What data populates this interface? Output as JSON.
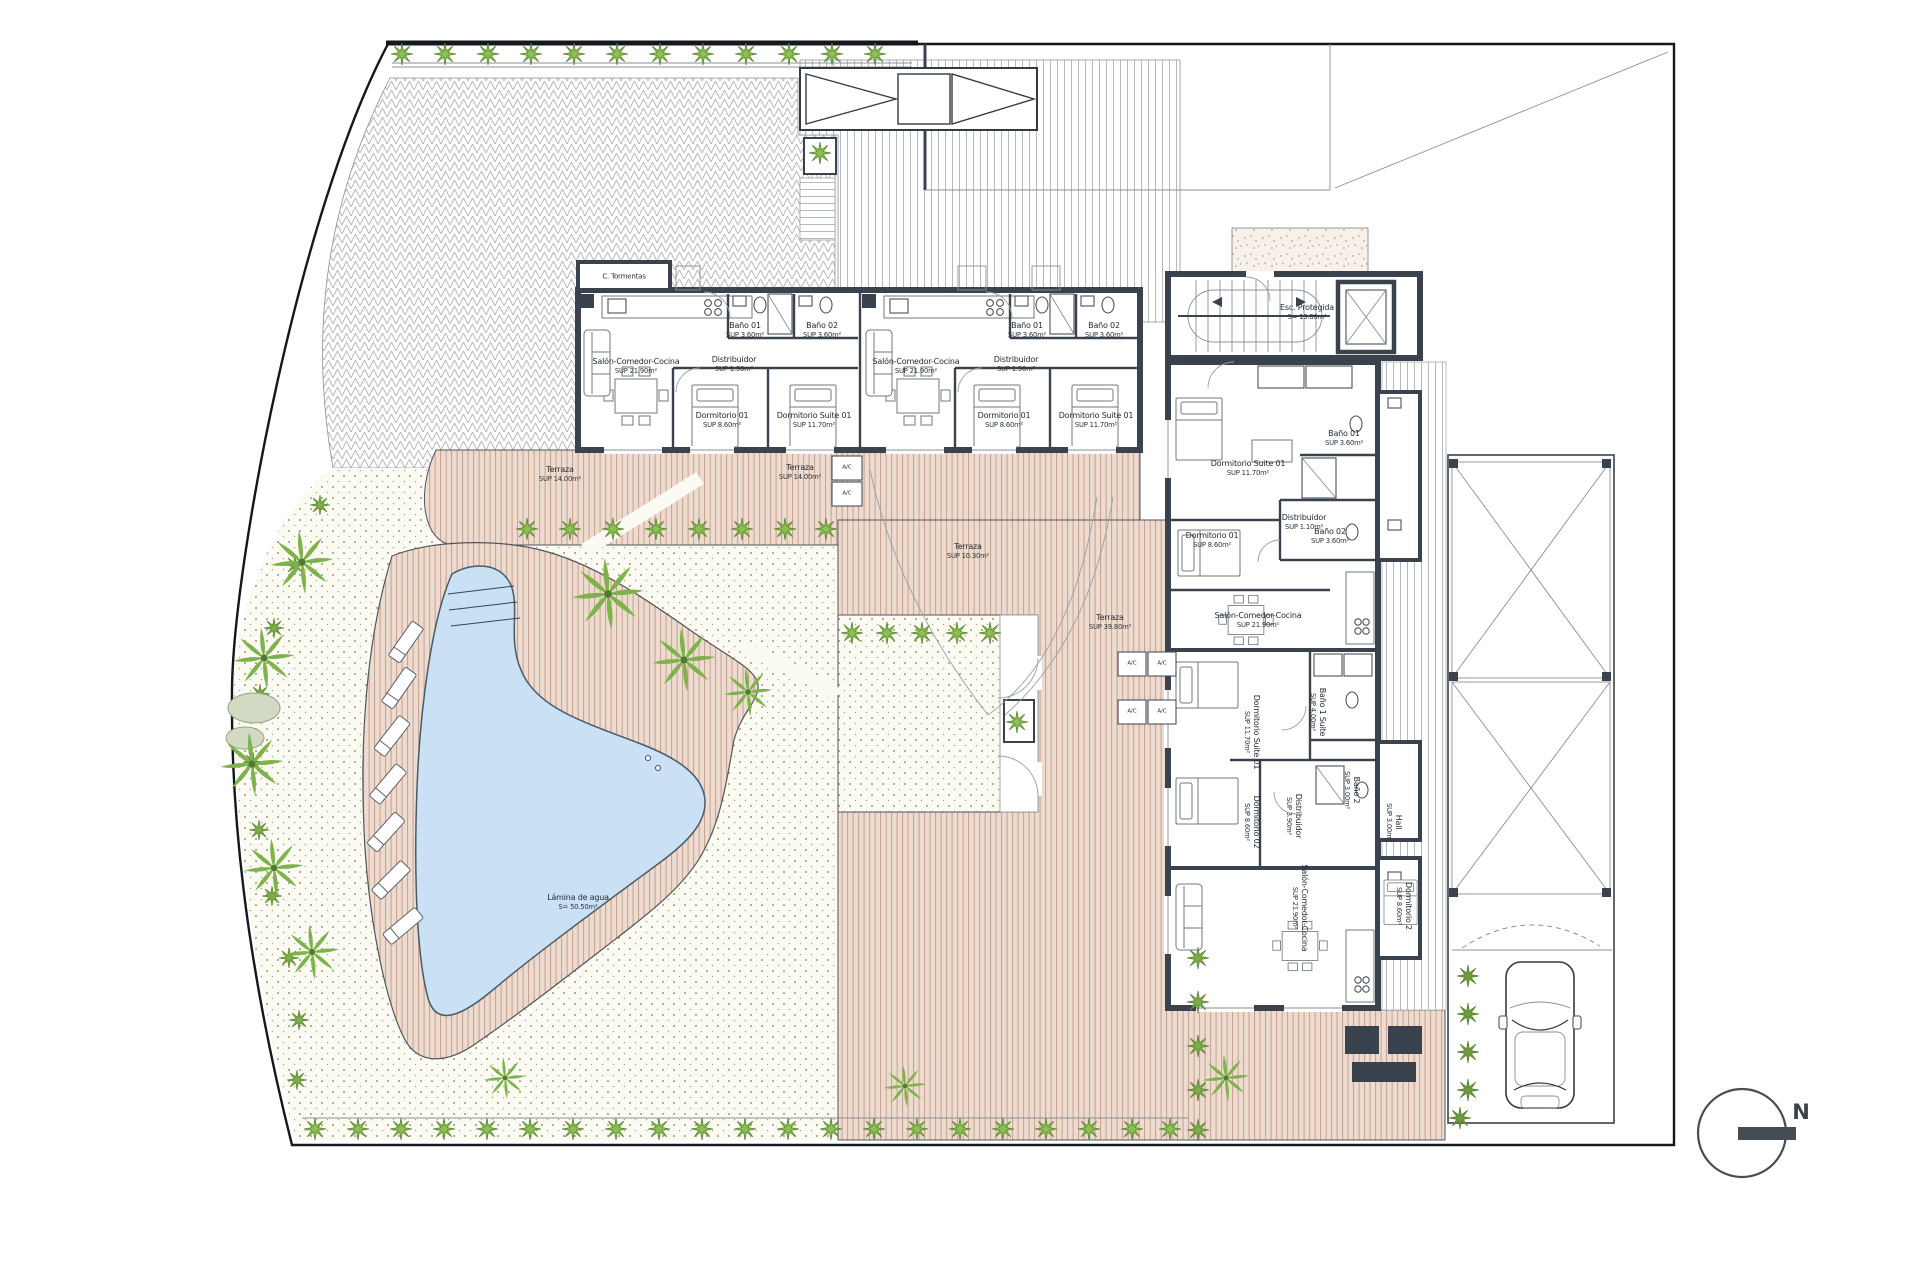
{
  "plan": {
    "compass": "N",
    "storm_closet": "C. Tormentas",
    "ac": "A/C",
    "pool": {
      "n": "Lámina de agua",
      "a": "S= 50.50m²"
    },
    "stair": {
      "n": "Esc. Protegida",
      "a": "S= 13.80m²"
    },
    "units": {
      "a": {
        "salon": {
          "n": "Salón-Comedor-Cocina",
          "a": "SUP 21.90m²"
        },
        "bano1": {
          "n": "Baño 01",
          "a": "SUP 3.60m²"
        },
        "bano2": {
          "n": "Baño 02",
          "a": "SUP 3.60m²"
        },
        "distribuidor": {
          "n": "Distribuidor",
          "a": "SUP 1.90m²"
        },
        "dorm1": {
          "n": "Dormitorio 01",
          "a": "SUP 8.60m²"
        },
        "suite": {
          "n": "Dormitorio Suite 01",
          "a": "SUP 11.70m²"
        }
      },
      "b": {
        "salon": {
          "n": "Salón-Comedor-Cocina",
          "a": "SUP 21.90m²"
        },
        "bano1": {
          "n": "Baño 01",
          "a": "SUP 3.60m²"
        },
        "bano2": {
          "n": "Baño 02",
          "a": "SUP 3.60m²"
        },
        "distribuidor": {
          "n": "Distribuidor",
          "a": "SUP 1.90m²"
        },
        "dorm1": {
          "n": "Dormitorio 01",
          "a": "SUP 8.60m²"
        },
        "suite": {
          "n": "Dormitorio Suite 01",
          "a": "SUP 11.70m²"
        }
      },
      "c": {
        "salon": {
          "n": "Salón-Comedor-Cocina",
          "a": "SUP 21.90m²"
        },
        "bano1": {
          "n": "Baño 01",
          "a": "SUP 3.60m²"
        },
        "bano2": {
          "n": "Baño 02",
          "a": "SUP 3.60m²"
        },
        "distribuidor": {
          "n": "Distribuidor",
          "a": "SUP 1.10m²"
        },
        "dorm1": {
          "n": "Dormitorio 01",
          "a": "SUP 8.60m²"
        },
        "suite": {
          "n": "Dormitorio Suite 01",
          "a": "SUP 11.70m²"
        }
      },
      "d": {
        "suite": {
          "n": "Dormitorio Suite 01",
          "a": "SUP 11.70m²"
        },
        "banosuite": {
          "n": "Baño 1 Suite",
          "a": "SUP 4.00m²"
        },
        "dorm2": {
          "n": "Dormitorio 02",
          "a": "SUP 8.60m²"
        },
        "distribuidor": {
          "n": "Distribuidor",
          "a": "SUP 3.90m²"
        },
        "bano2": {
          "n": "Baño 2",
          "a": "SUP 3.00m²"
        },
        "hall": {
          "n": "Hall",
          "a": "SUP 3.00m²"
        }
      },
      "e": {
        "salon": {
          "n": "Salón-Comedor-Cocina",
          "a": "SUP 21.90m²"
        },
        "dorm2": {
          "n": "Dormitorio 2",
          "a": "SUP 8.60m²"
        }
      }
    },
    "terrazas": [
      {
        "n": "Terraza",
        "a": "SUP 14.00m²"
      },
      {
        "n": "Terraza",
        "a": "SUP 14.00m²"
      },
      {
        "n": "Terraza",
        "a": "SUP 10.30m²"
      },
      {
        "n": "Terraza",
        "a": "SUP 39.80m²"
      }
    ]
  }
}
